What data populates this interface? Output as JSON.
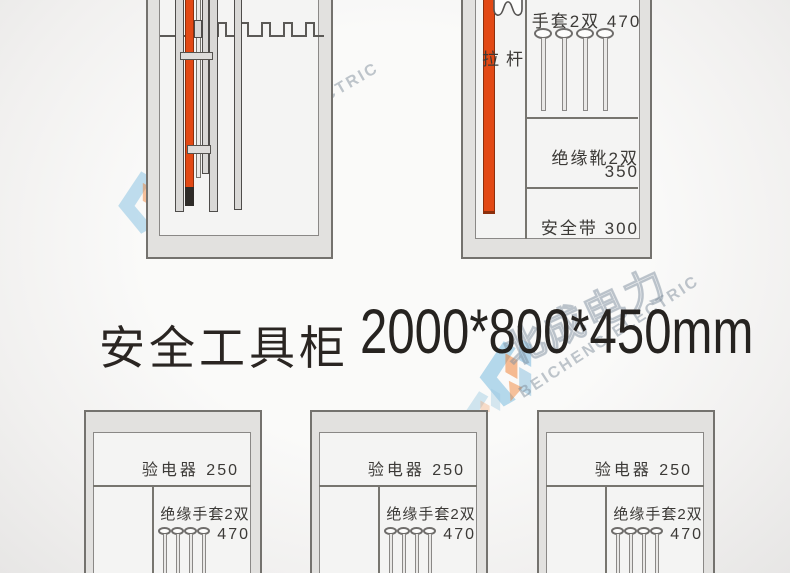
{
  "title": {
    "name_zh": "安全工具柜",
    "dimensions": "2000*800*450mm"
  },
  "watermark": {
    "brand_zh": "北成电力",
    "brand_en": "BEICHENG ELECTRIC"
  },
  "top_right_cabinet": {
    "rod_label": "拉杆",
    "shelf1_label": "手套2双",
    "shelf1_value": "470",
    "shelf2_label": "绝缘靴2双",
    "shelf2_value": "350",
    "shelf3_label": "安全带",
    "shelf3_value": "300"
  },
  "bottom_cabinets": [
    {
      "row1_label": "验电器",
      "row1_value": "250",
      "row2_label": "绝缘手套2双",
      "row2_value": "470"
    },
    {
      "row1_label": "验电器",
      "row1_value": "250",
      "row2_label": "绝缘手套2双",
      "row2_value": "470"
    },
    {
      "row1_label": "验电器",
      "row1_value": "250",
      "row2_label": "绝缘手套2双",
      "row2_value": "470"
    }
  ],
  "colors": {
    "accent_orange": "#e24915",
    "frame_gray": "#e2e1df",
    "outline_gray": "#74726e"
  }
}
